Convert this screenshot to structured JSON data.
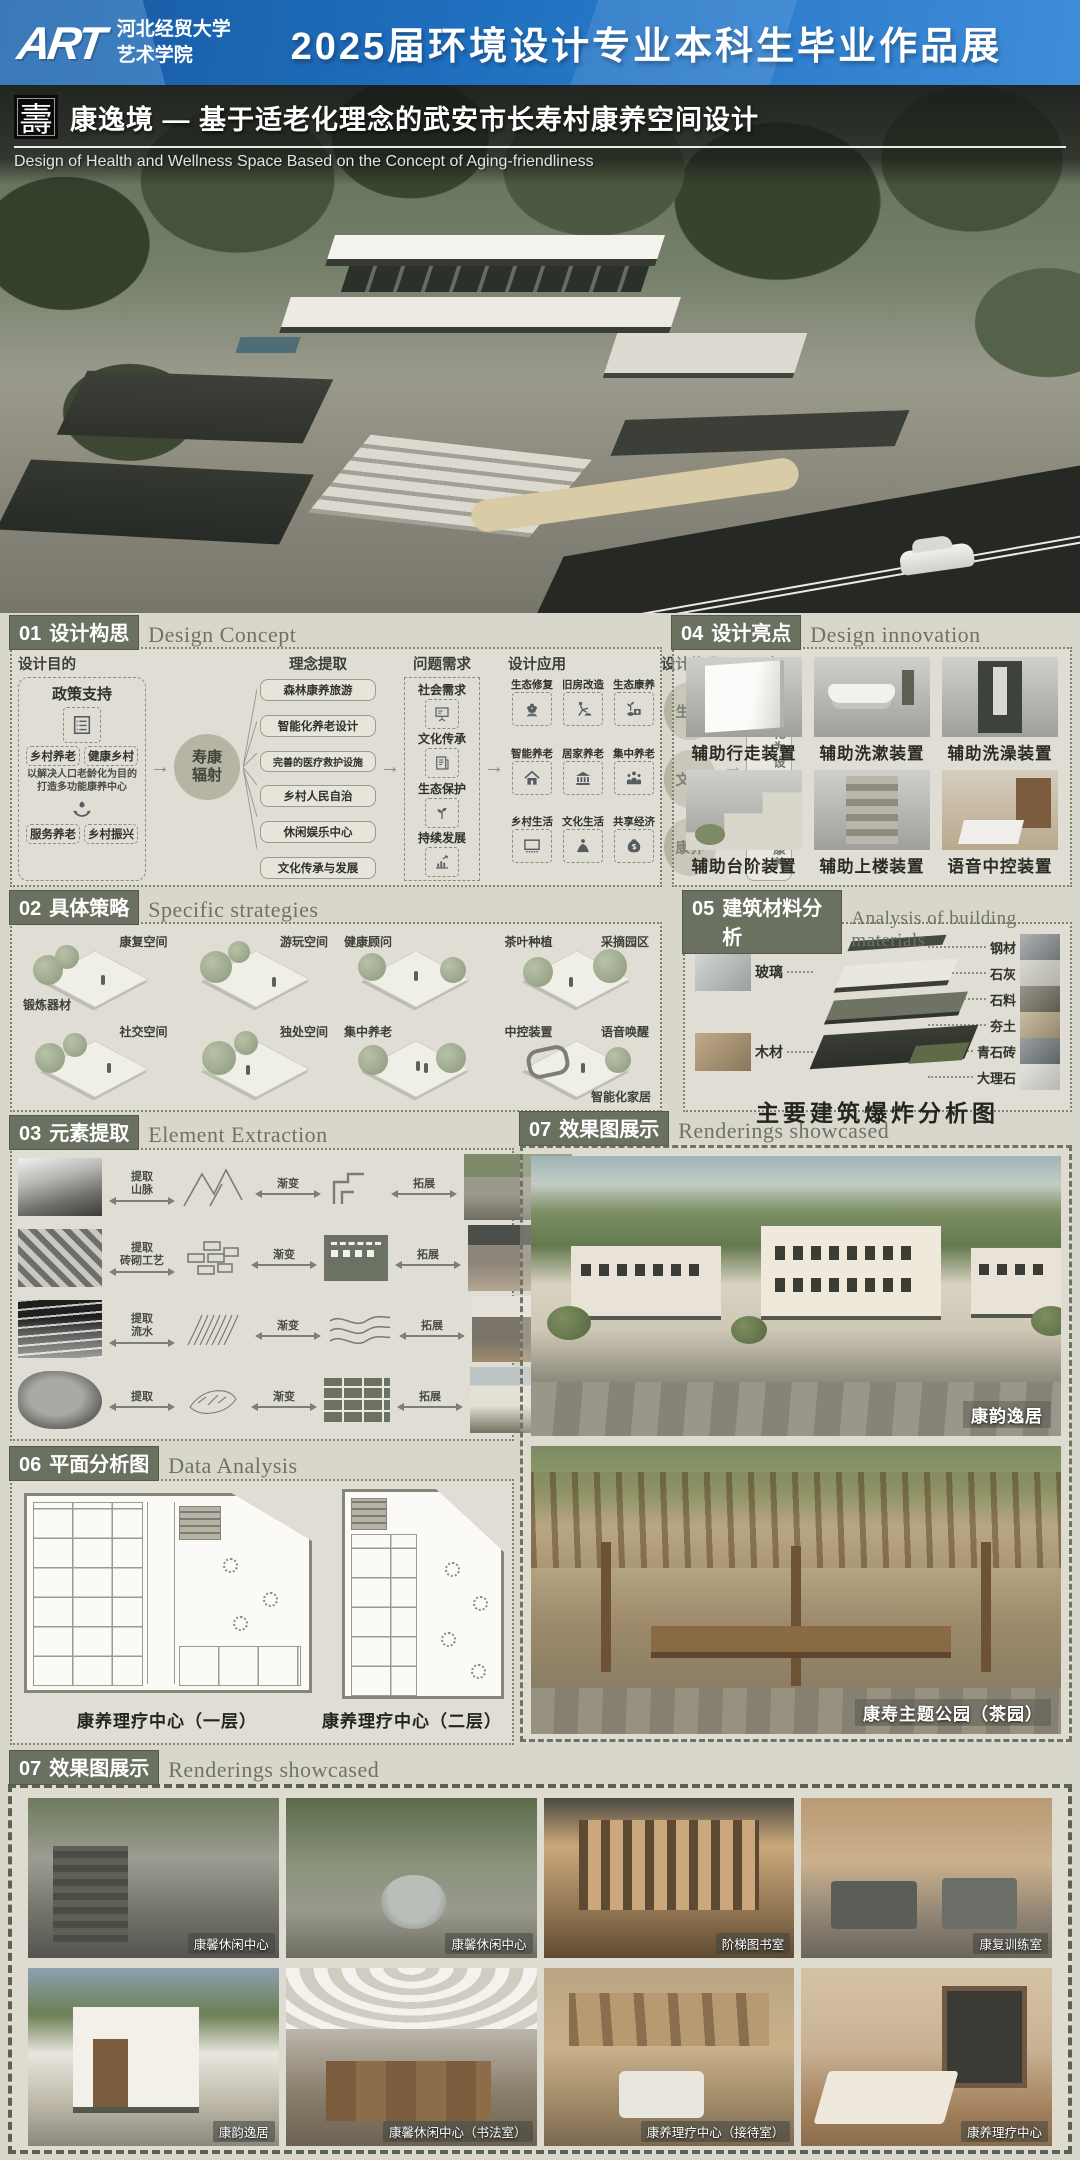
{
  "banner": {
    "logo": "ART",
    "school_line1": "河北经贸大学",
    "school_line2": "艺术学院",
    "title": "2025届环境设计专业本科生毕业作品展"
  },
  "title_bar": {
    "seal": "壽",
    "title": "康逸境 — 基于适老化理念的武安市长寿村康养空间设计",
    "subtitle": "Design of Health and Wellness Space Based on the Concept of Aging-friendliness"
  },
  "ui": {
    "arrow": "→"
  },
  "sections": {
    "s01": {
      "num": "01",
      "zh": "设计构思",
      "en": "Design Concept"
    },
    "s02": {
      "num": "02",
      "zh": "具体策略",
      "en": "Specific strategies"
    },
    "s03": {
      "num": "03",
      "zh": "元素提取",
      "en": "Element Extraction"
    },
    "s04": {
      "num": "04",
      "zh": "设计亮点",
      "en": "Design innovation"
    },
    "s05": {
      "num": "05",
      "zh": "建筑材料分析",
      "en": "Analysis of building materials"
    },
    "s06": {
      "num": "06",
      "zh": "平面分析图",
      "en": "Data Analysis"
    },
    "s07r": {
      "num": "07",
      "zh": "效果图展示",
      "en": "Renderings showcased"
    },
    "s07b": {
      "num": "07",
      "zh": "效果图展示",
      "en": "Renderings showcased"
    }
  },
  "concept": {
    "purpose_label": "设计目的",
    "policy_title": "政策支持",
    "tags_top": [
      "乡村养老",
      "健康乡村"
    ],
    "purpose_text": "以解决人口老龄化为目的打造多功能康养中心",
    "tags_bottom": [
      "服务养老",
      "乡村振兴"
    ],
    "hub": "寿康辐射",
    "extract_label": "理念提取",
    "extract_items": [
      "森林康养旅游",
      "智能化养老设计",
      "完善的医疗救护设施",
      "乡村人民自治",
      "休闲娱乐中心",
      "文化传承与发展"
    ],
    "needs_label": "问题需求",
    "needs_items": [
      "社会需求",
      "文化传承",
      "生态保护",
      "持续发展"
    ],
    "apply_label": "设计应用",
    "apply_items": [
      "生态修复",
      "旧房改造",
      "生态康养",
      "智能养老",
      "居家养老",
      "集中养老",
      "乡村生活",
      "文化生活",
      "共享经济"
    ],
    "embody_label": "设计体现",
    "embody_items": [
      "生态",
      "文化",
      "康养"
    ],
    "goal_label": "目标",
    "goal_text": "以适老化为设计理念打造康养空间"
  },
  "strategies": {
    "scenes": [
      {
        "labels": [
          "康复空间",
          "锻炼器材"
        ]
      },
      {
        "labels": [
          "游玩空间"
        ]
      },
      {
        "labels": [
          "健康顾问"
        ]
      },
      {
        "labels": [
          "茶叶种植",
          "采摘园区"
        ]
      },
      {
        "labels": [
          "社交空间"
        ]
      },
      {
        "labels": [
          "独处空间"
        ]
      },
      {
        "labels": [
          "集中养老"
        ]
      },
      {
        "labels": [
          "中控装置",
          "语音唤醒",
          "智能化家居"
        ]
      }
    ]
  },
  "highlights": {
    "items": [
      "辅助行走装置",
      "辅助洗漱装置",
      "辅助洗澡装置",
      "辅助台阶装置",
      "辅助上楼装置",
      "语音中控装置"
    ]
  },
  "materials": {
    "left": [
      "玻璃",
      "木材"
    ],
    "right": [
      "钢材",
      "石灰",
      "石料",
      "夯土",
      "青石砖",
      "大理石"
    ],
    "caption": "主要建筑爆炸分析图"
  },
  "elements": {
    "rows": [
      {
        "extract": "提取",
        "subject": "山脉",
        "morph": "渐变",
        "expand": "拓展"
      },
      {
        "extract": "提取",
        "subject": "砖砌工艺",
        "morph": "渐变",
        "expand": "拓展"
      },
      {
        "extract": "提取",
        "subject": "流水",
        "morph": "渐变",
        "expand": "拓展"
      },
      {
        "extract": "提取",
        "subject": "",
        "morph": "渐变",
        "expand": "拓展"
      }
    ]
  },
  "plans": {
    "captions": [
      "康养理疗中心（一层）",
      "康养理疗中心（二层）"
    ]
  },
  "renderings": {
    "captions": [
      "康韵逸居",
      "康寿主题公园（茶园）"
    ]
  },
  "gallery": {
    "captions": [
      "康馨休闲中心",
      "康馨休闲中心",
      "阶梯图书室",
      "康复训练室",
      "康韵逸居",
      "康馨休闲中心（书法室）",
      "康养理疗中心（接待室）",
      "康养理疗中心"
    ]
  }
}
